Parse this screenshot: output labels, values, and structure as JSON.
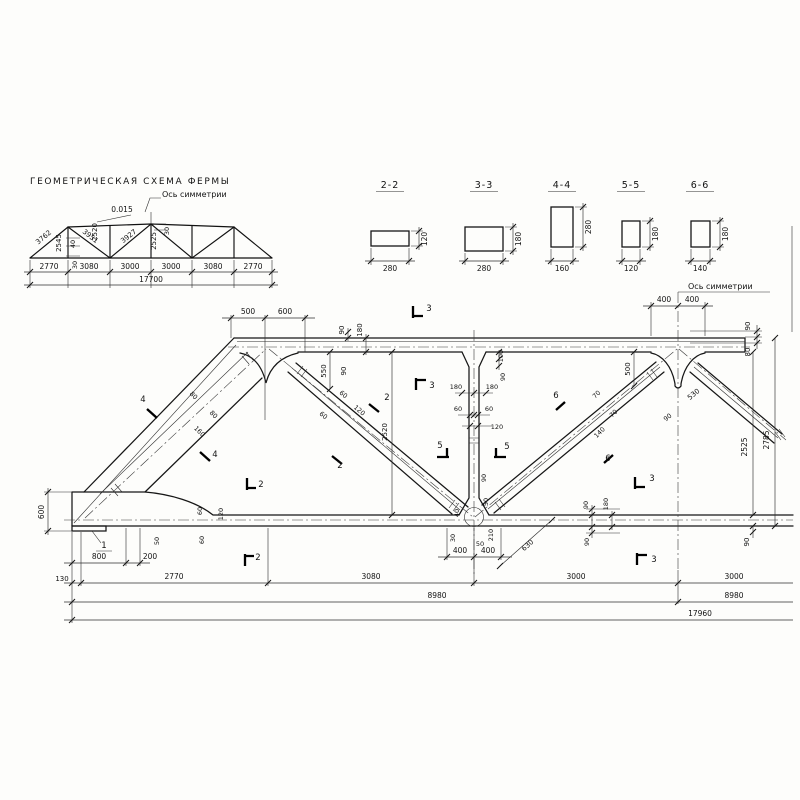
{
  "drawing": {
    "title": "ГЕОМЕТРИЧЕСКАЯ СХЕМА ФЕРМЫ",
    "scheme_axis_label": "Ось симметрии",
    "elevation_axis_label": "Ось симметрии"
  },
  "sections": [
    {
      "name": "2-2",
      "width": "280",
      "height": "120"
    },
    {
      "name": "3-3",
      "width": "280",
      "height": "180"
    },
    {
      "name": "4-4",
      "width": "160",
      "height": "280"
    },
    {
      "name": "5-5",
      "width": "120",
      "height": "180"
    },
    {
      "name": "6-6",
      "width": "140",
      "height": "180"
    }
  ],
  "scheme": {
    "slope": "0.015",
    "member_lengths": [
      "3762",
      "2545",
      "3951",
      "2520",
      "3927",
      "2525"
    ],
    "offset_dims": [
      "40",
      "30",
      "30"
    ],
    "panel_dims": [
      "2770",
      "3080",
      "3000",
      "3000",
      "3080",
      "2770"
    ],
    "total_span": "17700"
  },
  "elevation": {
    "panel_dims": [
      "130",
      "2770",
      "3080",
      "3000",
      "3000"
    ],
    "half_span": "8980",
    "total_span": "17960",
    "left_end_height": "600",
    "clear_height": "2525",
    "overall_height": "2785"
  },
  "annotations": [
    {
      "n": "scheme-slope",
      "t": "0.015",
      "x": 122,
      "y": 212,
      "s": 7.5
    },
    {
      "n": "scheme-diag-1",
      "t": "3762",
      "x": 45,
      "y": 239,
      "r": -40,
      "s": 7
    },
    {
      "n": "scheme-vert-1",
      "t": "2545",
      "x": 61,
      "y": 243,
      "r": -90,
      "s": 7
    },
    {
      "n": "scheme-diag-2",
      "t": "3951",
      "x": 89,
      "y": 238,
      "r": 38,
      "s": 7
    },
    {
      "n": "scheme-vert-2",
      "t": "2520",
      "x": 97,
      "y": 232,
      "r": -90,
      "s": 7
    },
    {
      "n": "scheme-diag-3",
      "t": "3927",
      "x": 130,
      "y": 238,
      "r": -38,
      "s": 7
    },
    {
      "n": "scheme-vert-mid",
      "t": "2525",
      "x": 156,
      "y": 241,
      "r": -90,
      "s": 7
    },
    {
      "n": "scheme-off-40",
      "t": "40",
      "x": 75,
      "y": 244,
      "r": -90,
      "s": 6.5
    },
    {
      "n": "scheme-off-30a",
      "t": "30",
      "x": 77,
      "y": 265,
      "r": -90,
      "s": 6.5
    },
    {
      "n": "scheme-off-30b",
      "t": "30",
      "x": 169,
      "y": 231,
      "r": -90,
      "s": 6.5
    },
    {
      "n": "scheme-panel-1",
      "t": "2770",
      "x": 49,
      "y": 269,
      "s": 7.5
    },
    {
      "n": "scheme-panel-2",
      "t": "3080",
      "x": 89,
      "y": 269,
      "s": 7.5
    },
    {
      "n": "scheme-panel-3",
      "t": "3000",
      "x": 130,
      "y": 269,
      "s": 7.5
    },
    {
      "n": "scheme-panel-4",
      "t": "3000",
      "x": 171,
      "y": 269,
      "s": 7.5
    },
    {
      "n": "scheme-panel-5",
      "t": "3080",
      "x": 213,
      "y": 269,
      "s": 7.5
    },
    {
      "n": "scheme-panel-6",
      "t": "2770",
      "x": 253,
      "y": 269,
      "s": 7.5
    },
    {
      "n": "scheme-total",
      "t": "17700",
      "x": 151,
      "y": 282,
      "s": 7.5
    },
    {
      "n": "sec22-width",
      "t": "280",
      "x": 390,
      "y": 271
    },
    {
      "n": "sec22-height",
      "t": "120",
      "x": 427,
      "y": 239,
      "r": -90
    },
    {
      "n": "sec33-width",
      "t": "280",
      "x": 484,
      "y": 271
    },
    {
      "n": "sec33-height",
      "t": "180",
      "x": 521,
      "y": 239,
      "r": -90
    },
    {
      "n": "sec44-width",
      "t": "160",
      "x": 562,
      "y": 271
    },
    {
      "n": "sec44-height",
      "t": "280",
      "x": 591,
      "y": 227,
      "r": -90
    },
    {
      "n": "sec55-width",
      "t": "120",
      "x": 631,
      "y": 271
    },
    {
      "n": "sec55-height",
      "t": "180",
      "x": 658,
      "y": 234,
      "r": -90
    },
    {
      "n": "sec66-width",
      "t": "140",
      "x": 700,
      "y": 271
    },
    {
      "n": "sec66-height",
      "t": "180",
      "x": 728,
      "y": 234,
      "r": -90
    },
    {
      "n": "dim-500",
      "t": "500",
      "x": 248,
      "y": 314
    },
    {
      "n": "dim-600-top",
      "t": "600",
      "x": 285,
      "y": 314
    },
    {
      "n": "dim-400-tl",
      "t": "400",
      "x": 664,
      "y": 302
    },
    {
      "n": "dim-400-tr",
      "t": "400",
      "x": 692,
      "y": 302
    },
    {
      "n": "dim-90-tr",
      "t": "90",
      "x": 750,
      "y": 326,
      "r": -90,
      "s": 7
    },
    {
      "n": "dim-80-tr",
      "t": "80",
      "x": 750,
      "y": 352,
      "r": -90,
      "s": 7
    },
    {
      "n": "dim-2525",
      "t": "2525",
      "x": 747,
      "y": 447,
      "r": -90
    },
    {
      "n": "dim-2785",
      "t": "2785",
      "x": 769,
      "y": 440,
      "r": -90
    },
    {
      "n": "dim-90-br",
      "t": "90",
      "x": 749,
      "y": 542,
      "r": -90,
      "s": 7
    },
    {
      "n": "dim-90-tc",
      "t": "90",
      "x": 344,
      "y": 330,
      "r": -90,
      "s": 7
    },
    {
      "n": "dim-180-tc",
      "t": "180",
      "x": 362,
      "y": 330,
      "r": -90,
      "s": 7
    },
    {
      "n": "dim-550",
      "t": "550",
      "x": 326,
      "y": 371,
      "r": -90,
      "s": 7
    },
    {
      "n": "dim-90-g1",
      "t": "90",
      "x": 346,
      "y": 371,
      "r": -90,
      "s": 7
    },
    {
      "n": "dim-180-vl",
      "t": "180",
      "x": 456,
      "y": 389,
      "s": 6.5
    },
    {
      "n": "dim-180-vr",
      "t": "180",
      "x": 492,
      "y": 389,
      "s": 6.5
    },
    {
      "n": "dim-100-v",
      "t": "100",
      "x": 503,
      "y": 356,
      "r": -90,
      "s": 6.5
    },
    {
      "n": "dim-90-v",
      "t": "90",
      "x": 505,
      "y": 377,
      "r": -90,
      "s": 6.5
    },
    {
      "n": "dim-60-vl",
      "t": "60",
      "x": 458,
      "y": 411,
      "s": 6.5
    },
    {
      "n": "dim-60-vr",
      "t": "60",
      "x": 489,
      "y": 411,
      "s": 6.5
    },
    {
      "n": "dim-120-v",
      "t": "120",
      "x": 497,
      "y": 429,
      "s": 6.5
    },
    {
      "n": "dim-60-d1a",
      "t": "60",
      "x": 342,
      "y": 396,
      "r": 40,
      "s": 6.5
    },
    {
      "n": "dim-60-d1b",
      "t": "60",
      "x": 322,
      "y": 417,
      "r": 40,
      "s": 6.5
    },
    {
      "n": "dim-120-d1",
      "t": "120",
      "x": 358,
      "y": 412,
      "r": 40,
      "s": 6.5
    },
    {
      "n": "dim-2520",
      "t": "2520",
      "x": 387,
      "y": 432,
      "r": -90,
      "s": 7
    },
    {
      "n": "dim-80-d0a",
      "t": "80",
      "x": 192,
      "y": 397,
      "r": 45,
      "s": 6.5
    },
    {
      "n": "dim-80-d0b",
      "t": "80",
      "x": 212,
      "y": 416,
      "r": 45,
      "s": 6.5
    },
    {
      "n": "dim-160-d0",
      "t": "160",
      "x": 198,
      "y": 433,
      "r": 45,
      "s": 6.5
    },
    {
      "n": "dim-70-d2a",
      "t": "70",
      "x": 598,
      "y": 396,
      "r": -45,
      "s": 6.5
    },
    {
      "n": "dim-70-d2b",
      "t": "70",
      "x": 615,
      "y": 415,
      "r": -45,
      "s": 6.5
    },
    {
      "n": "dim-140-d2",
      "t": "140",
      "x": 601,
      "y": 434,
      "r": -45,
      "s": 6.5
    },
    {
      "n": "dim-530",
      "t": "530",
      "x": 695,
      "y": 396,
      "r": -40,
      "s": 7
    },
    {
      "n": "dim-90-ax",
      "t": "90",
      "x": 669,
      "y": 419,
      "r": -40,
      "s": 6.5
    },
    {
      "n": "dim-500-ax",
      "t": "500",
      "x": 630,
      "y": 369,
      "r": -90,
      "s": 7
    },
    {
      "n": "dim-90-vb",
      "t": "90",
      "x": 486,
      "y": 478,
      "r": -90,
      "s": 6.5
    },
    {
      "n": "dim-50-vb",
      "t": "50",
      "x": 488,
      "y": 502,
      "r": -90,
      "s": 6.5
    },
    {
      "n": "dim-40-c",
      "t": "40",
      "x": 459,
      "y": 513,
      "r": -90,
      "s": 6.5
    },
    {
      "n": "dim-30-c",
      "t": "30",
      "x": 455,
      "y": 538,
      "r": -90,
      "s": 6.5
    },
    {
      "n": "dim-50-c",
      "t": "50",
      "x": 480,
      "y": 546,
      "s": 6.5
    },
    {
      "n": "dim-210-c",
      "t": "210",
      "x": 493,
      "y": 535,
      "r": -90,
      "s": 6.5
    },
    {
      "n": "dim-630",
      "t": "630",
      "x": 529,
      "y": 547,
      "r": -41,
      "s": 7
    },
    {
      "n": "dim-50-bc",
      "t": "50",
      "x": 159,
      "y": 541,
      "r": -90,
      "s": 6.5
    },
    {
      "n": "dim-60-bca",
      "t": "60",
      "x": 202,
      "y": 511,
      "r": -90,
      "s": 6.5
    },
    {
      "n": "dim-60-bcb",
      "t": "60",
      "x": 204,
      "y": 540,
      "r": -90,
      "s": 6.5
    },
    {
      "n": "dim-120-bc",
      "t": "120",
      "x": 223,
      "y": 514,
      "r": -90,
      "s": 6.5
    },
    {
      "n": "dim-90-bra",
      "t": "90",
      "x": 588,
      "y": 505,
      "r": -90,
      "s": 6.5
    },
    {
      "n": "dim-180-br",
      "t": "180",
      "x": 608,
      "y": 504,
      "r": -90,
      "s": 6.5
    },
    {
      "n": "dim-90-brb",
      "t": "90",
      "x": 589,
      "y": 542,
      "r": -90,
      "s": 6.5
    },
    {
      "n": "dim-600-left",
      "t": "600",
      "x": 44,
      "y": 512,
      "r": -90
    },
    {
      "n": "dim-130",
      "t": "130",
      "x": 62,
      "y": 581,
      "s": 7
    },
    {
      "n": "dim-800",
      "t": "800",
      "x": 99,
      "y": 559
    },
    {
      "n": "dim-200",
      "t": "200",
      "x": 150,
      "y": 559
    },
    {
      "n": "dim-400-bl",
      "t": "400",
      "x": 460,
      "y": 553
    },
    {
      "n": "dim-400-br",
      "t": "400",
      "x": 488,
      "y": 553
    },
    {
      "n": "dim-2770-el",
      "t": "2770",
      "x": 174,
      "y": 579
    },
    {
      "n": "dim-3080-el",
      "t": "3080",
      "x": 371,
      "y": 579
    },
    {
      "n": "dim-3000-a",
      "t": "3000",
      "x": 576,
      "y": 579
    },
    {
      "n": "dim-3000-b",
      "t": "3000",
      "x": 734,
      "y": 579
    },
    {
      "n": "dim-8980-a",
      "t": "8980",
      "x": 437,
      "y": 598
    },
    {
      "n": "dim-8980-b",
      "t": "8980",
      "x": 734,
      "y": 598
    },
    {
      "n": "dim-17960",
      "t": "17960",
      "x": 700,
      "y": 616
    },
    {
      "n": "callout-1",
      "t": "1",
      "x": 104,
      "y": 548,
      "s": 8.5
    },
    {
      "n": "mark-2-a",
      "t": "2",
      "x": 261,
      "y": 487,
      "s": 8.5
    },
    {
      "n": "mark-2-b",
      "t": "2",
      "x": 258,
      "y": 560,
      "s": 8.5
    },
    {
      "n": "mark-2-c",
      "t": "2",
      "x": 387,
      "y": 400,
      "s": 8.5
    },
    {
      "n": "mark-2-d",
      "t": "2",
      "x": 340,
      "y": 468,
      "s": 8.5
    },
    {
      "n": "mark-3-a",
      "t": "3",
      "x": 429,
      "y": 311,
      "s": 8.5
    },
    {
      "n": "mark-3-b",
      "t": "3",
      "x": 432,
      "y": 388,
      "s": 8.5
    },
    {
      "n": "mark-3-c",
      "t": "3",
      "x": 652,
      "y": 481,
      "s": 8.5
    },
    {
      "n": "mark-3-d",
      "t": "3",
      "x": 654,
      "y": 562,
      "s": 8.5
    },
    {
      "n": "mark-4-a",
      "t": "4",
      "x": 143,
      "y": 402,
      "s": 8.5
    },
    {
      "n": "mark-4-b",
      "t": "4",
      "x": 215,
      "y": 457,
      "s": 8.5
    },
    {
      "n": "mark-5-a",
      "t": "5",
      "x": 440,
      "y": 448,
      "s": 8.5
    },
    {
      "n": "mark-5-b",
      "t": "5",
      "x": 507,
      "y": 449,
      "s": 8.5
    },
    {
      "n": "mark-6-a",
      "t": "6",
      "x": 556,
      "y": 398,
      "s": 8.5
    },
    {
      "n": "mark-6-b",
      "t": "6",
      "x": 608,
      "y": 461,
      "s": 8.5
    }
  ]
}
